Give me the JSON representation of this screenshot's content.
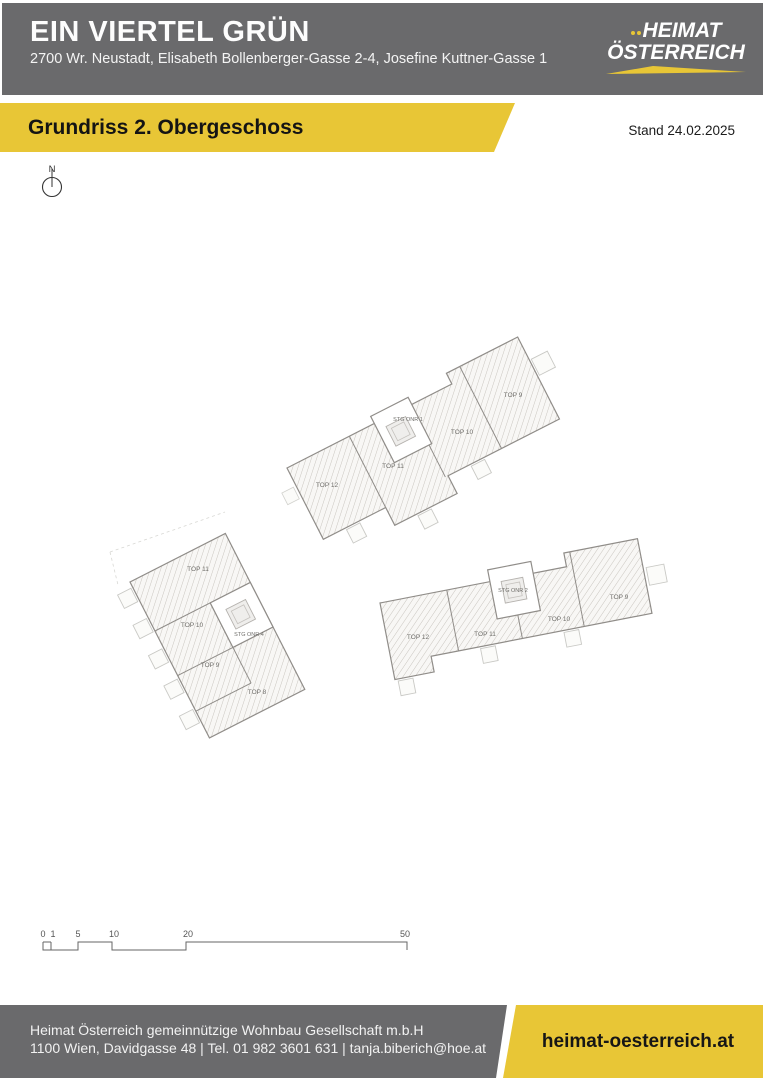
{
  "header": {
    "title": "EIN VIERTEL GRÜN",
    "address": "2700 Wr. Neustadt, Elisabeth Bollenberger-Gasse 2-4, Josefine Kuttner-Gasse 1",
    "logo_line1": "HEIMAT",
    "logo_line2": "ÖSTERREICH"
  },
  "banner": {
    "title": "Grundriss 2. Obergeschoss",
    "stand": "Stand 24.02.2025"
  },
  "plan": {
    "north_label": "N",
    "buildings": {
      "north": {
        "units": [
          "TOP 12",
          "TOP 11",
          "STG ONR 1",
          "TOP 10",
          "TOP 9"
        ]
      },
      "west": {
        "units": [
          "TOP 11",
          "TOP 10",
          "STG ONR 4",
          "TOP 9",
          "TOP 8"
        ]
      },
      "east": {
        "units": [
          "TOP 12",
          "TOP 11",
          "STG ONR 2",
          "TOP 10",
          "TOP 9"
        ]
      }
    },
    "scale_bar": {
      "labels": [
        "0",
        "1",
        "5",
        "10",
        "20",
        "50"
      ]
    }
  },
  "footer": {
    "company": "Heimat Österreich gemeinnützige Wohnbau Gesellschaft m.b.H",
    "contact": "1100 Wien, Davidgasse 48 | Tel. 01 982 3601 631 | tanja.biberich@hoe.at",
    "website": "heimat-oesterreich.at"
  },
  "colors": {
    "brand_yellow": "#e8c636",
    "brand_gray": "#6a6a6c",
    "hatch_line": "#c9c5bf",
    "wall_line": "#908d89"
  }
}
